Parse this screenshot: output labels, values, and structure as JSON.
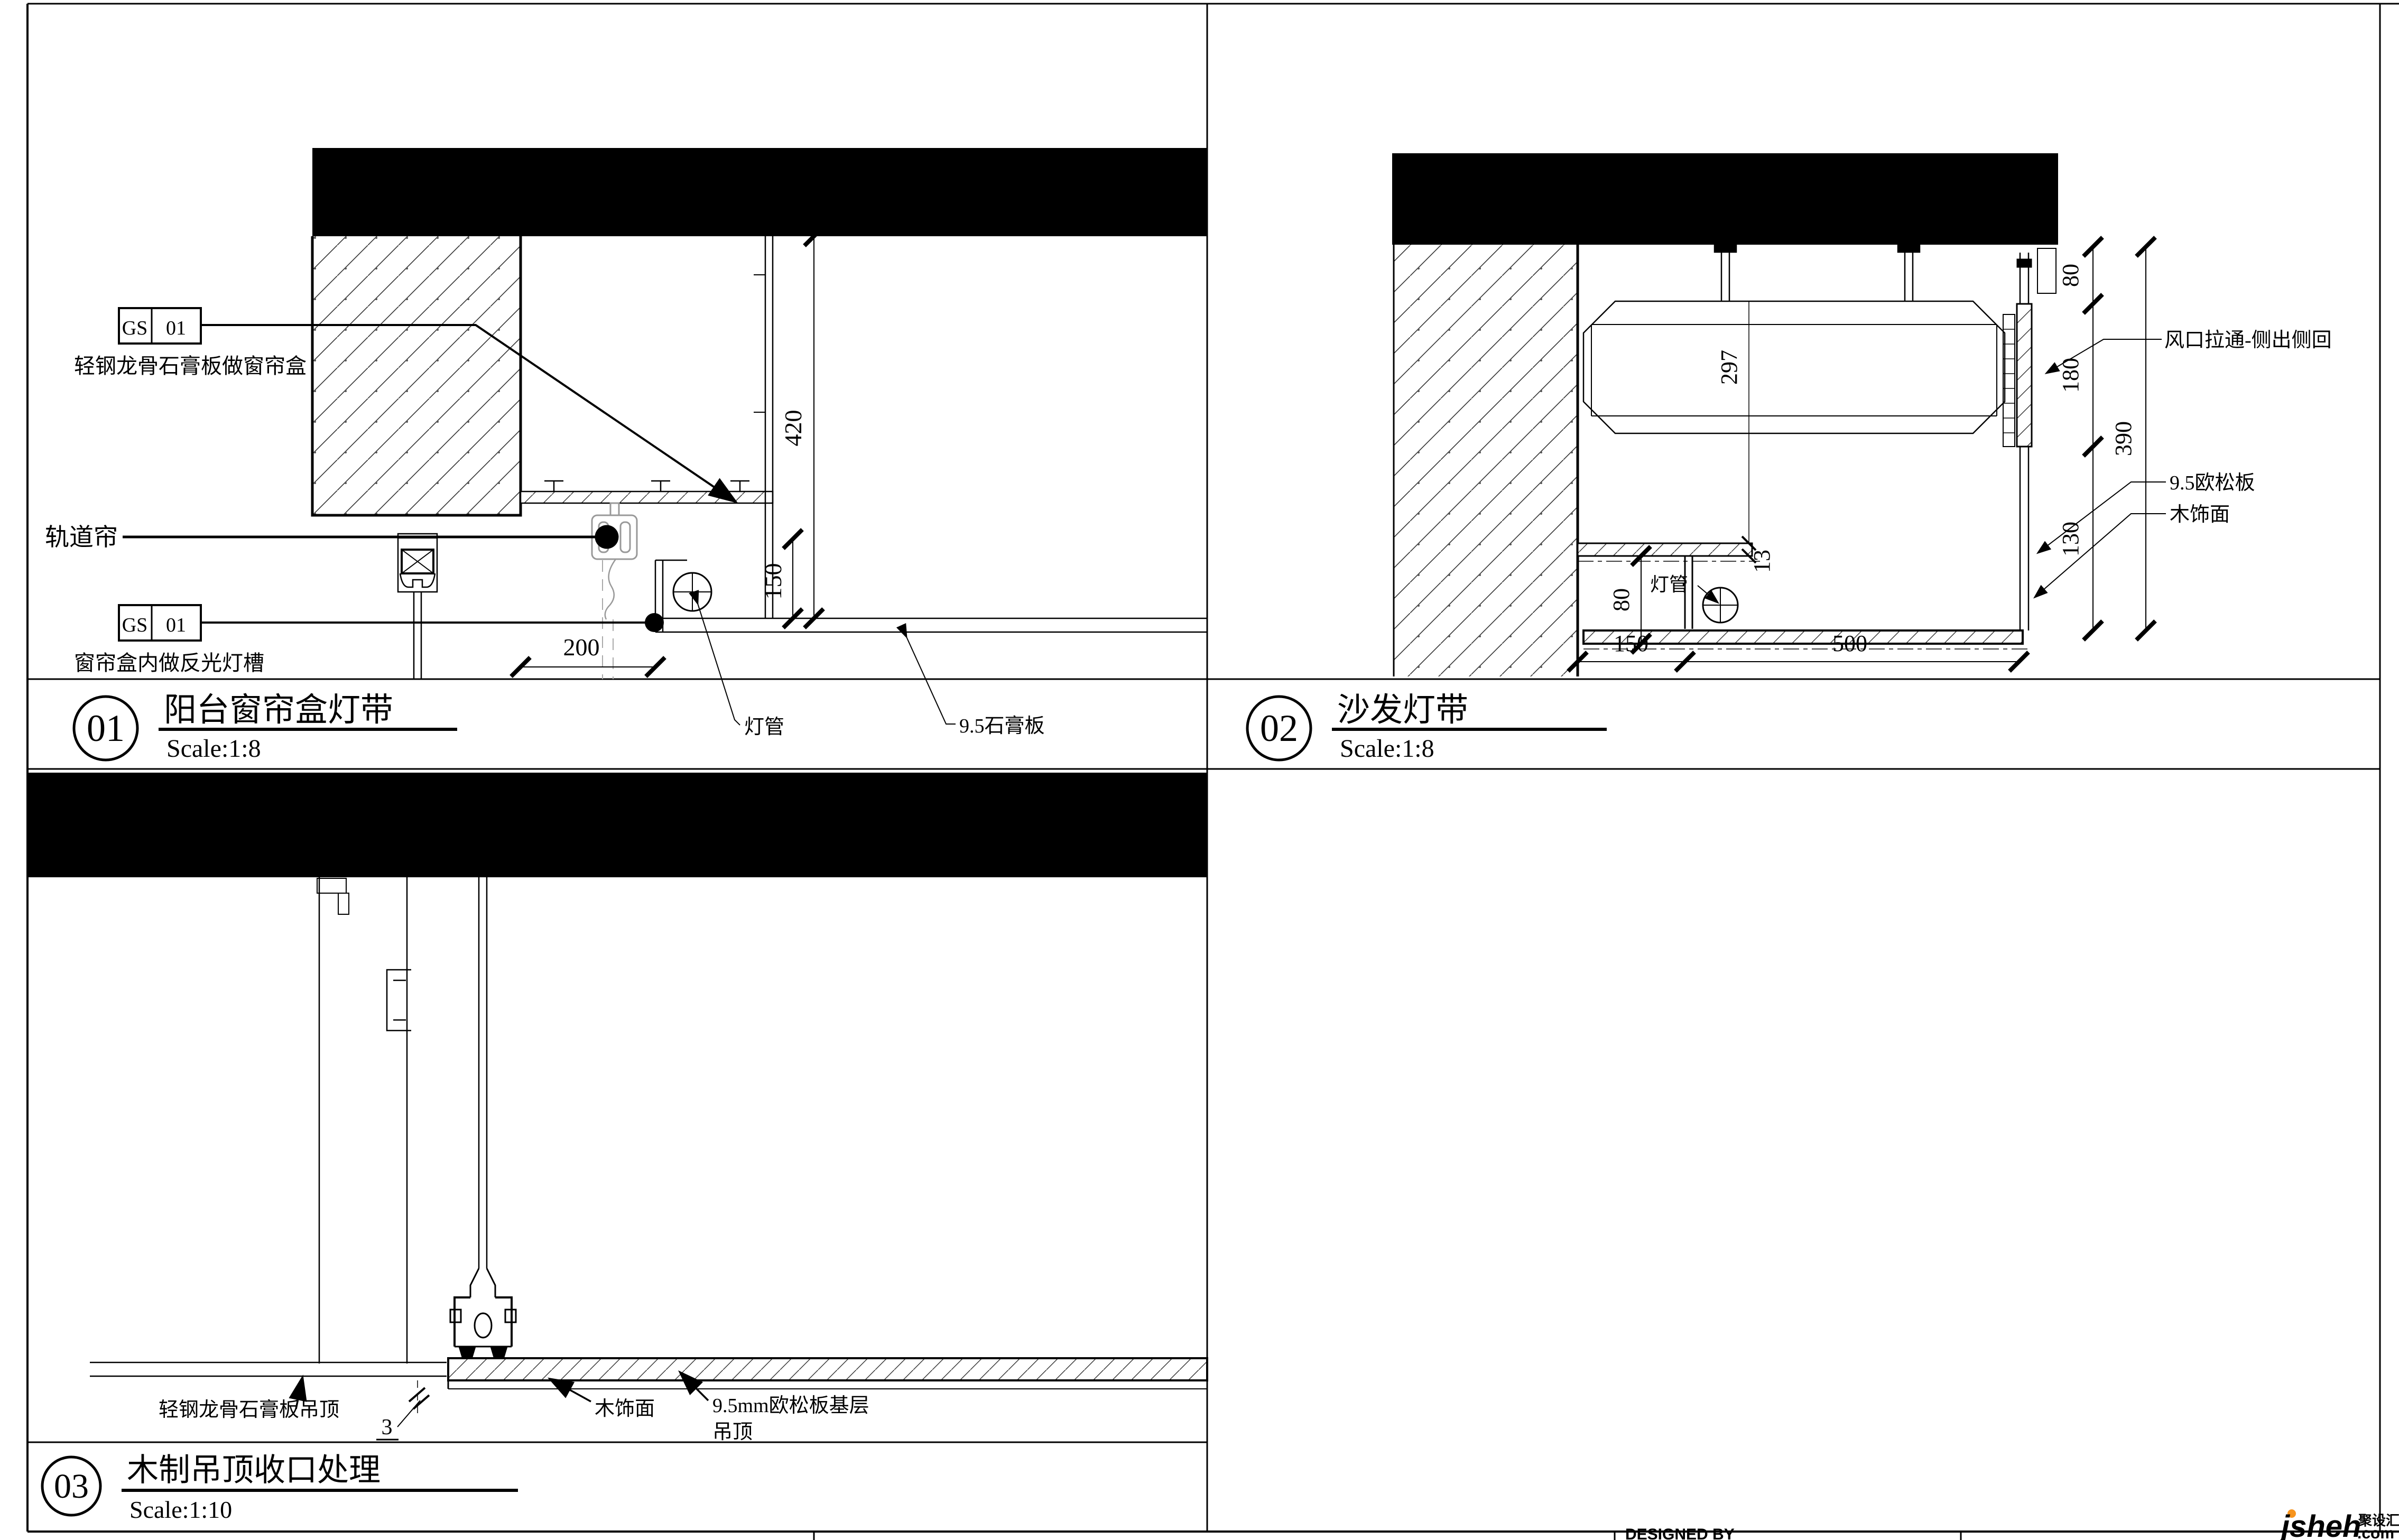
{
  "sheet": {
    "watermark": {
      "brand": "jsheh",
      "tld": ".com",
      "cn": "聚设汇"
    },
    "titleblock_partial": "DESIGNED BY"
  },
  "drawings": [
    {
      "id": "01",
      "title": "阳台窗帘盒灯带",
      "scale": "Scale:1:8",
      "labels": {
        "gs1_l": "GS",
        "gs1_r": "01",
        "gs1_text": "轻钢龙骨石膏板做窗帘盒",
        "track": "轨道帘",
        "gs2_l": "GS",
        "gs2_r": "01",
        "gs2_text": "窗帘盒内做反光灯槽",
        "lamp": "灯管",
        "board": "9.5石膏板"
      },
      "dims": {
        "v420": "420",
        "v150": "150",
        "h200": "200"
      }
    },
    {
      "id": "02",
      "title": "沙发灯带",
      "scale": "Scale:1:8",
      "labels": {
        "vent": "风口拉通-侧出侧回",
        "osb": "9.5欧松板",
        "wood": "木饰面",
        "lamp": "灯管"
      },
      "dims": {
        "duct297": "297",
        "gap13": "13",
        "l80": "80",
        "r80": "80",
        "r180": "180",
        "r390": "390",
        "r130": "130",
        "b150": "150",
        "b500": "500"
      }
    },
    {
      "id": "03",
      "title": "木制吊顶收口处理",
      "scale": "Scale:1:10",
      "labels": {
        "gypsum": "轻钢龙骨石膏板吊顶",
        "wood": "木饰面",
        "osb1": "9.5mm欧松板基层",
        "osb2": "吊顶",
        "gap3": "3"
      }
    }
  ]
}
